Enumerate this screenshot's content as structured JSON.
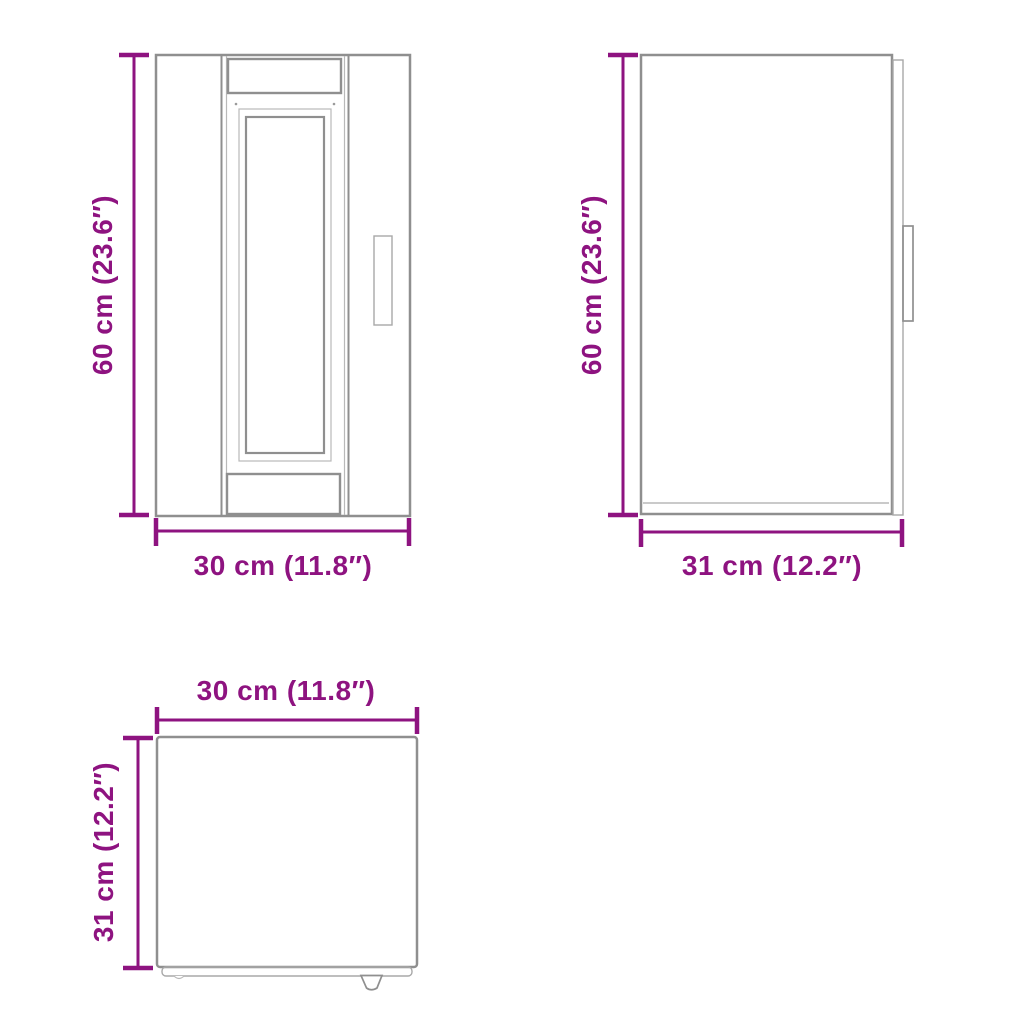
{
  "image": {
    "background_color": "#ffffff"
  },
  "colors": {
    "dimension_accent": "#8E1380",
    "outline_gray": "#8f8f8f",
    "outline_light_gray": "#b3b3b3"
  },
  "product_dimensions": {
    "height_cm": 60,
    "height_inches": 23.6,
    "width_cm": 30,
    "width_inches": 11.8,
    "depth_cm": 31,
    "depth_inches": 12.2
  },
  "views": {
    "front": {
      "height_label": "60 cm (23.6″)",
      "width_label": "30 cm (11.8″)"
    },
    "side": {
      "height_label": "60 cm (23.6″)",
      "depth_label": "31 cm (12.2″)"
    },
    "top": {
      "width_label": "30 cm (11.8″)",
      "depth_label": "31 cm (12.2″)"
    }
  }
}
